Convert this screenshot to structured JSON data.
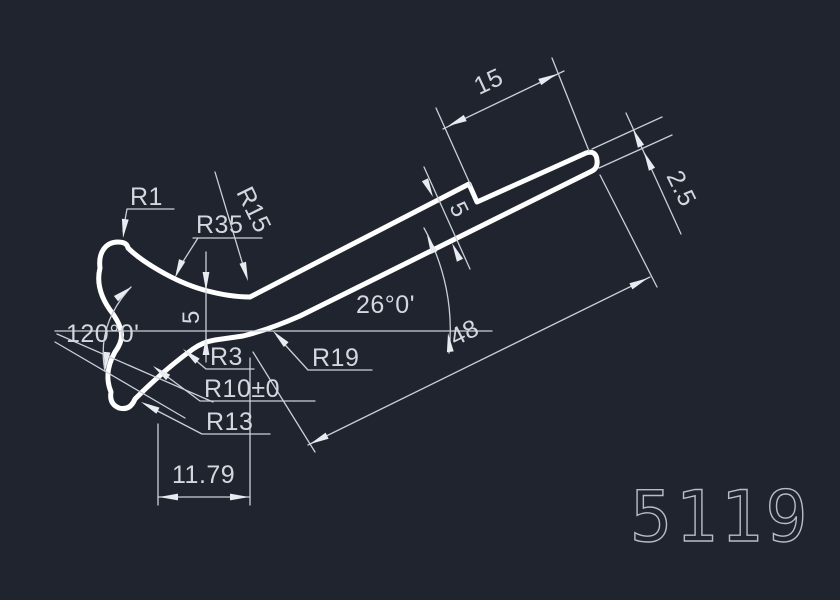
{
  "canvas": {
    "background": "#1f242e",
    "part_outline_color": "#ffffff",
    "dimension_line_color": "#c9cfd8",
    "dimension_text_color": "#d4d8de",
    "part_number_color": "#b7bdc6"
  },
  "part_number": "5119",
  "dims": {
    "r1": "R1",
    "r35": "R35",
    "r15": "R15",
    "head_angle": "120°0'",
    "neck_thickness": "5",
    "r3": "R3",
    "r10": "R10±0",
    "r13": "R13",
    "base_width": "11.79",
    "shaft_angle": "26°0'",
    "r19": "R19",
    "shaft_length": "48",
    "end_length": "15",
    "shaft_thickness": "5",
    "end_thickness": "2.5"
  }
}
